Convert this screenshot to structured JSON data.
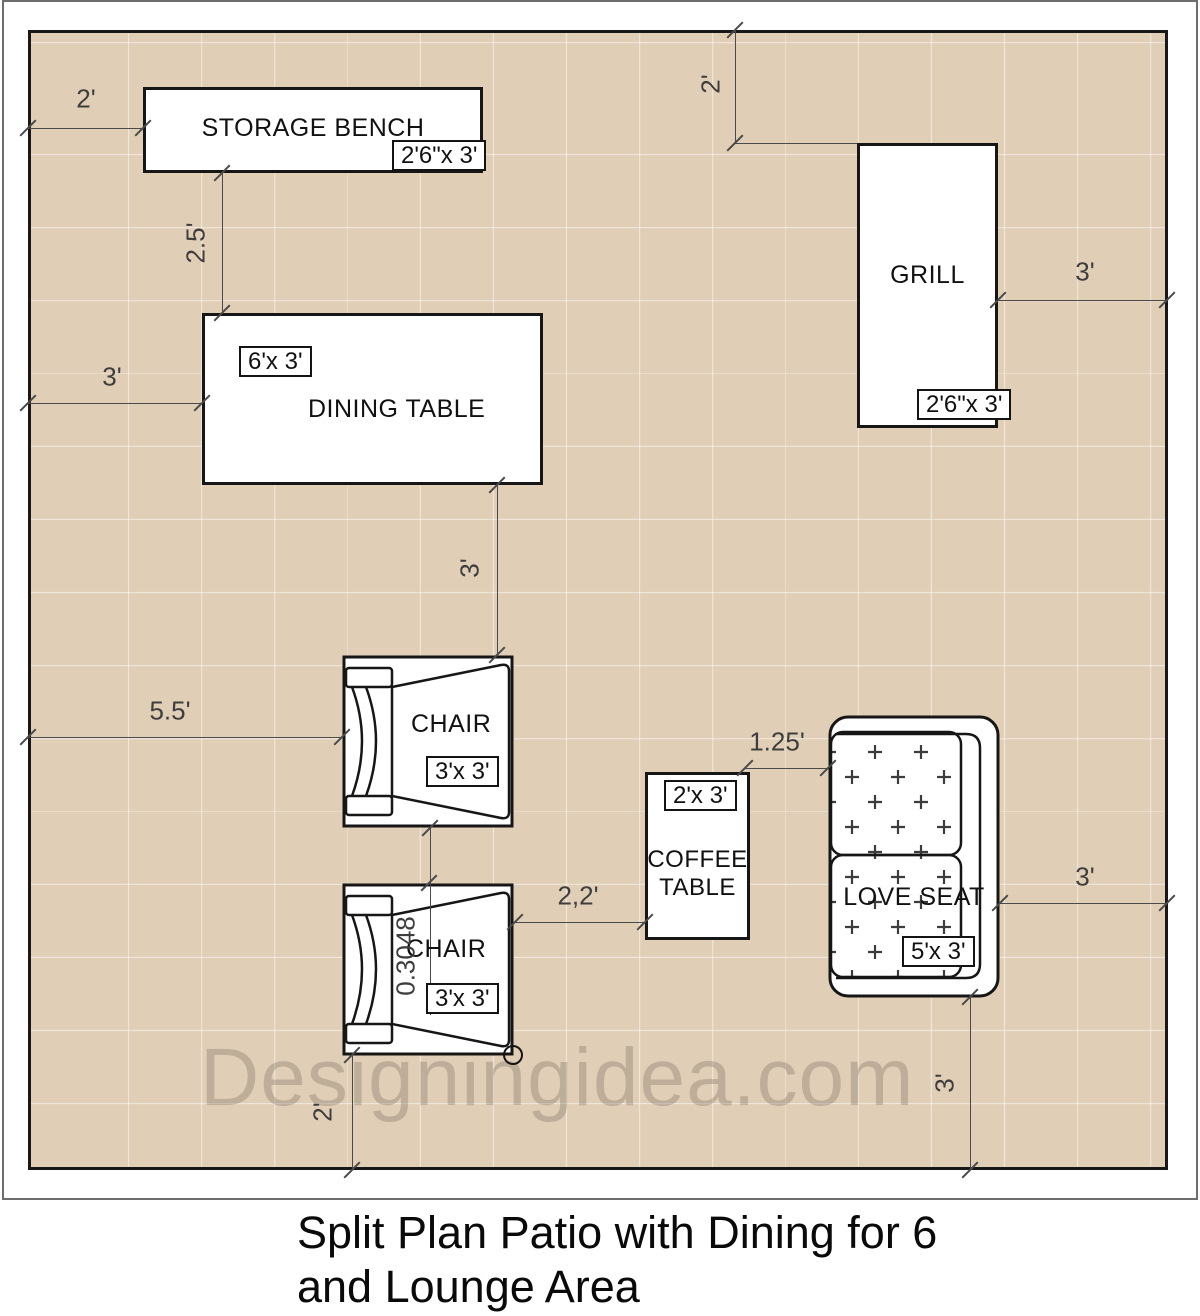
{
  "title": {
    "line1": "Split Plan Patio with Dining for 6",
    "line2": "and Lounge Area"
  },
  "watermark": "Designingidea.com",
  "furniture": {
    "storage_bench": {
      "name": "STORAGE BENCH",
      "size": "2'6\"x 3'"
    },
    "dining_table": {
      "name": "DINING TABLE",
      "size": "6'x 3'"
    },
    "grill": {
      "name": "GRILL",
      "size": "2'6\"x 3'"
    },
    "chair1": {
      "name": "CHAIR",
      "size": "3'x 3'"
    },
    "chair2": {
      "name": "CHAIR",
      "size": "3'x 3'"
    },
    "coffee_table": {
      "name_line1": "COFFEE",
      "name_line2": "TABLE",
      "size": "2'x 3'"
    },
    "love_seat": {
      "name": "LOVE SEAT",
      "size": "5'x 3'"
    }
  },
  "dimensions": {
    "bench_left": "2'",
    "bench_to_table": "2.5'",
    "table_left": "3'",
    "grill_top": "2'",
    "grill_right": "3'",
    "table_to_chair": "3'",
    "chair_left": "5.5'",
    "chair_gap": "0.3048",
    "chair_to_coffee": "2,2'",
    "coffee_to_loveseat": "1.25'",
    "loveseat_right": "3'",
    "loveseat_bottom": "3'",
    "chair2_bottom": "2'"
  },
  "colors": {
    "patio_fill": "#e1ceb6",
    "grid_line": "#f2e6d6",
    "outline": "#161616",
    "dimension": "#4a4a4a",
    "watermark": "#b4a794"
  }
}
